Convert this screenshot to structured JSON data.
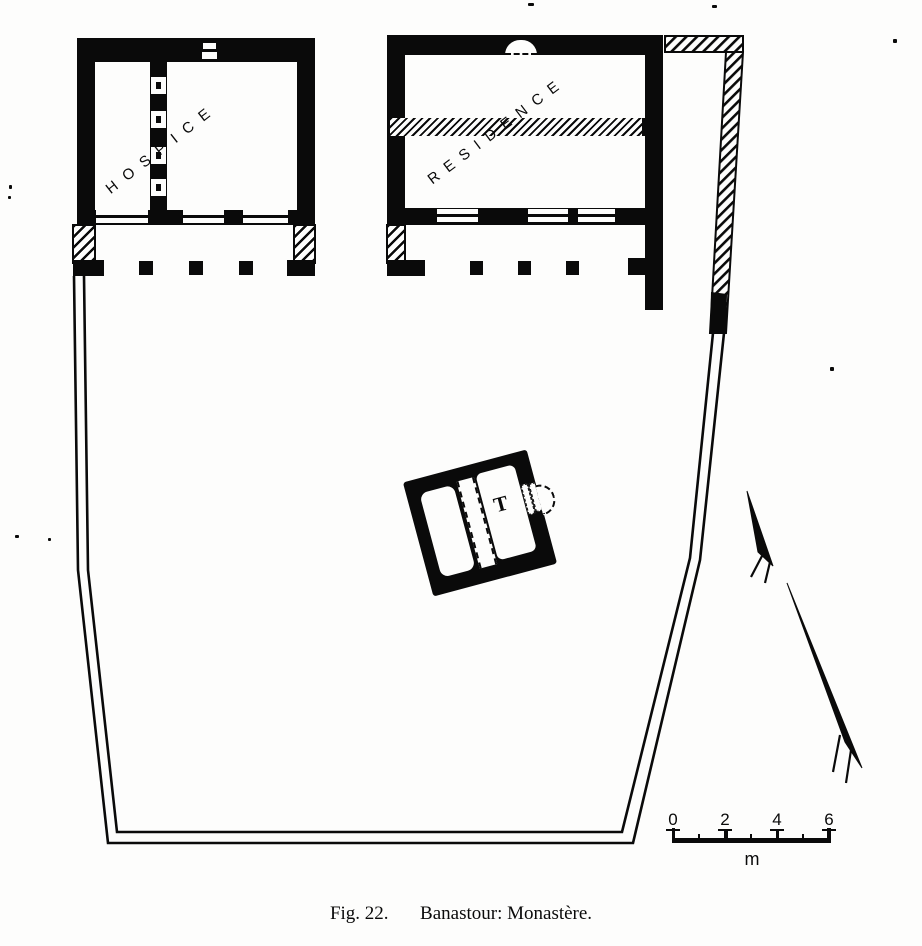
{
  "figure_caption": {
    "prefix": "Fig. 22.",
    "title": "Banastour: Monastère."
  },
  "buildings": {
    "hospice": {
      "label": "HOSPICE"
    },
    "residence": {
      "label": "RESIDENCE"
    },
    "tower": {
      "label": "T"
    }
  },
  "scale_bar": {
    "tick_labels": [
      "0",
      "2",
      "4",
      "6"
    ],
    "unit": "m"
  },
  "compass": {
    "icon": "north-arrow"
  },
  "colors": {
    "ink": "#0a0a0a",
    "paper": "#fdfdfc"
  }
}
